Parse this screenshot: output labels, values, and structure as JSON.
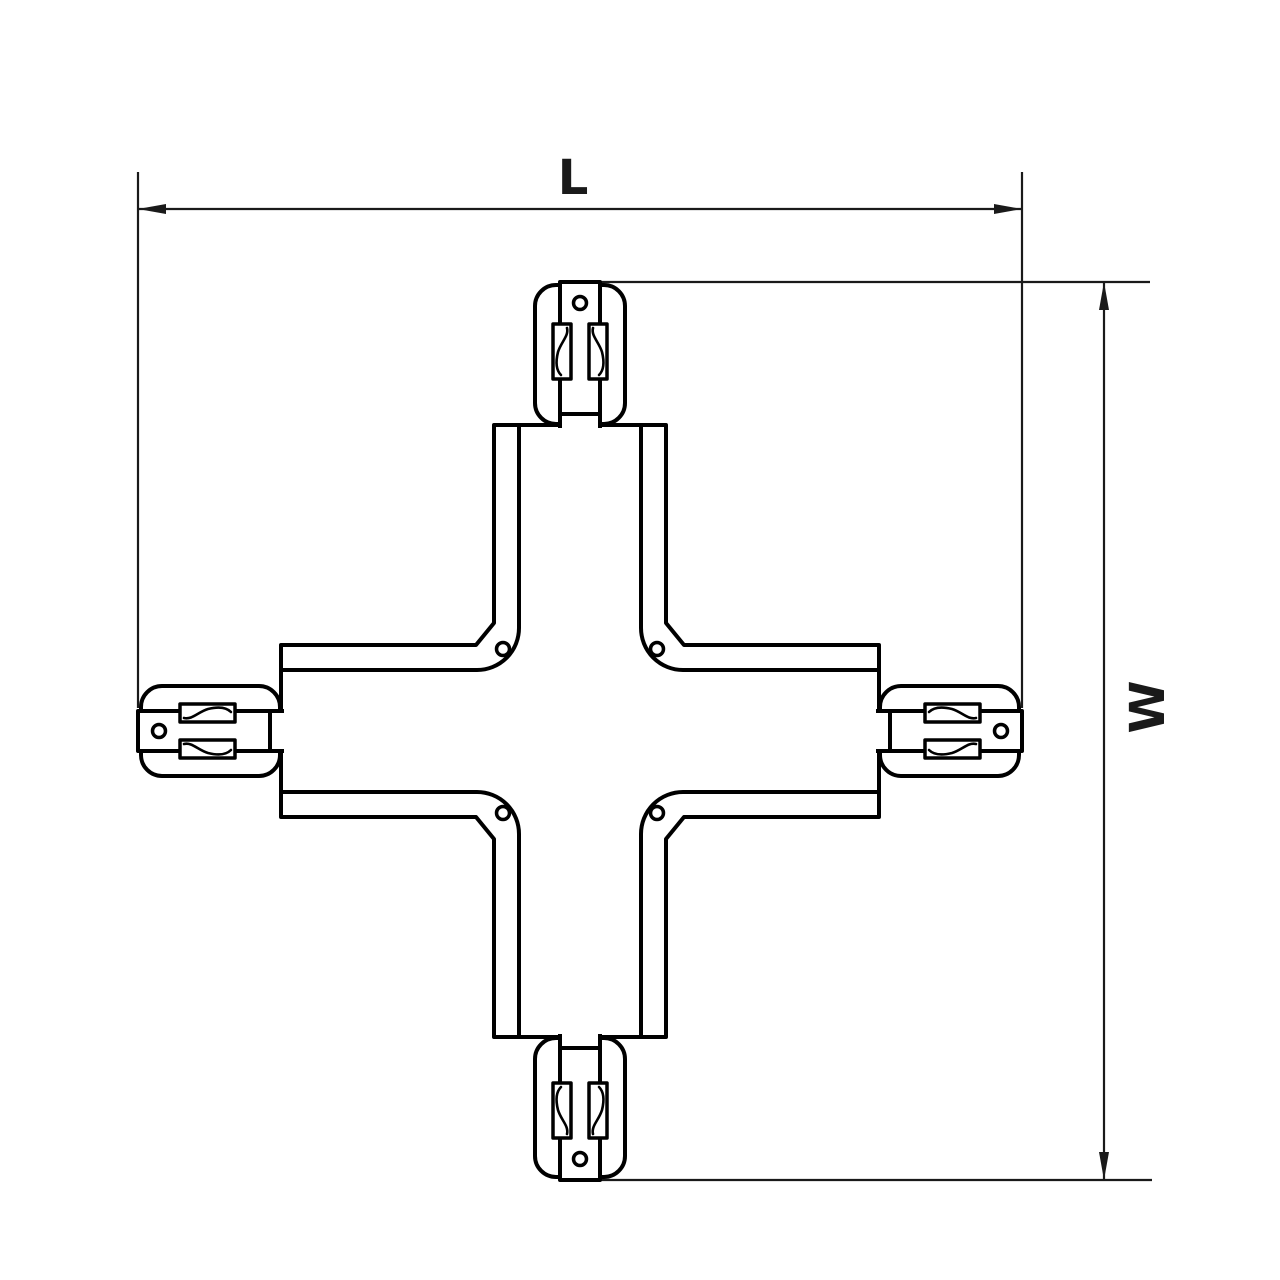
{
  "page": {
    "background": "#ffffff",
    "title": "X-shaped track connector dimension drawing"
  },
  "drawing": {
    "colors": {
      "line": "#000000",
      "dimension": "#1a1a1a",
      "fill": "#ffffff"
    },
    "labels": {
      "length": "L",
      "width": "W"
    }
  }
}
